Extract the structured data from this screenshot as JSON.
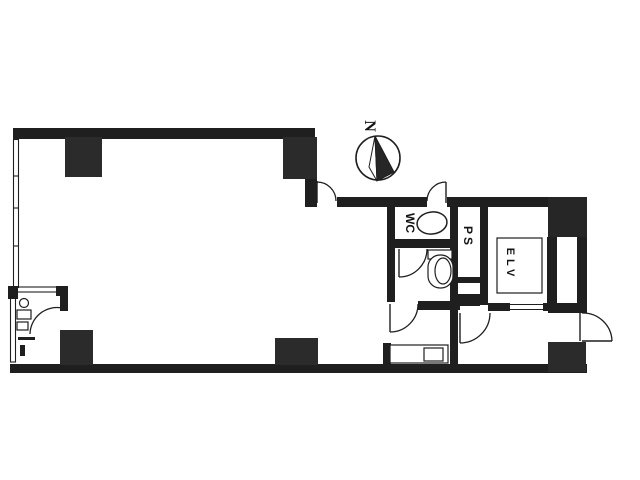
{
  "plan": {
    "compass": {
      "label": "N"
    },
    "labels": {
      "wc": "WC",
      "ps": "PS",
      "elevator": "ELV"
    },
    "colors": {
      "wall": "#1f1f1f",
      "column": "#2b2b2b",
      "background": "#ffffff"
    }
  }
}
